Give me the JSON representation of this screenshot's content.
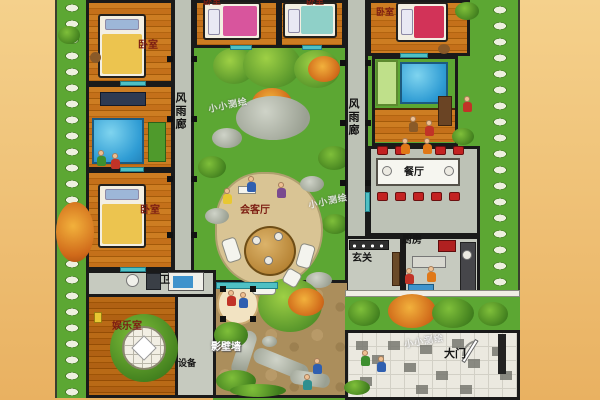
{
  "plan": {
    "labels": {
      "bedroom": "卧室",
      "corridor": "风雨廊",
      "reception": "会客厅",
      "dining": "餐厅",
      "kitchen": "厨房",
      "entry": "玄关",
      "bath": "卫",
      "games": "娱乐室",
      "equipment": "设备",
      "screen_wall": "影壁墙",
      "gate": "大门"
    },
    "watermark": "小小测绘",
    "colors": {
      "background": "#efc179",
      "grass": "#5ca733",
      "wood_floor": "#c4701a",
      "stone_path": "#bdc2b6",
      "wall": "#1a1a1a",
      "water": "#2f9cd4",
      "label_red": "#7c1d12",
      "chair_red": "#c32222"
    }
  }
}
